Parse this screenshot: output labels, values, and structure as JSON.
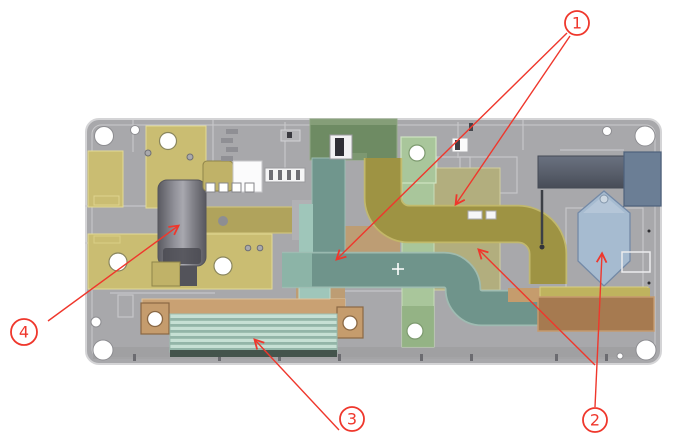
{
  "figure": {
    "kind": "cad-assembly-top-view",
    "background": "#ffffff"
  },
  "callouts": [
    {
      "label": "1"
    },
    {
      "label": "2"
    },
    {
      "label": "3"
    },
    {
      "label": "4"
    }
  ],
  "colors": {
    "accent_red": "#ef372c",
    "board_gray": "#a8a8ab",
    "brass": "#cabd72",
    "brass_dark": "#b0a35c",
    "teal": "#6f948b",
    "teal_light": "#9fc6ba",
    "olive": "#9e9343",
    "pale_olive": "#b2ae7e",
    "light_green": "#a9c69b",
    "dark_green": "#6e8b63",
    "copper_band": "#c9a173",
    "copper": "#c59c6d",
    "brown": "#a67a50",
    "slate": "#5e6573",
    "steel_blue": "#6b7e95",
    "light_blue": "#a6bbd0",
    "ribbed_light": "#c6e0d4",
    "ribbed_dark": "#93b5a8",
    "tan": "#bd9d74"
  }
}
